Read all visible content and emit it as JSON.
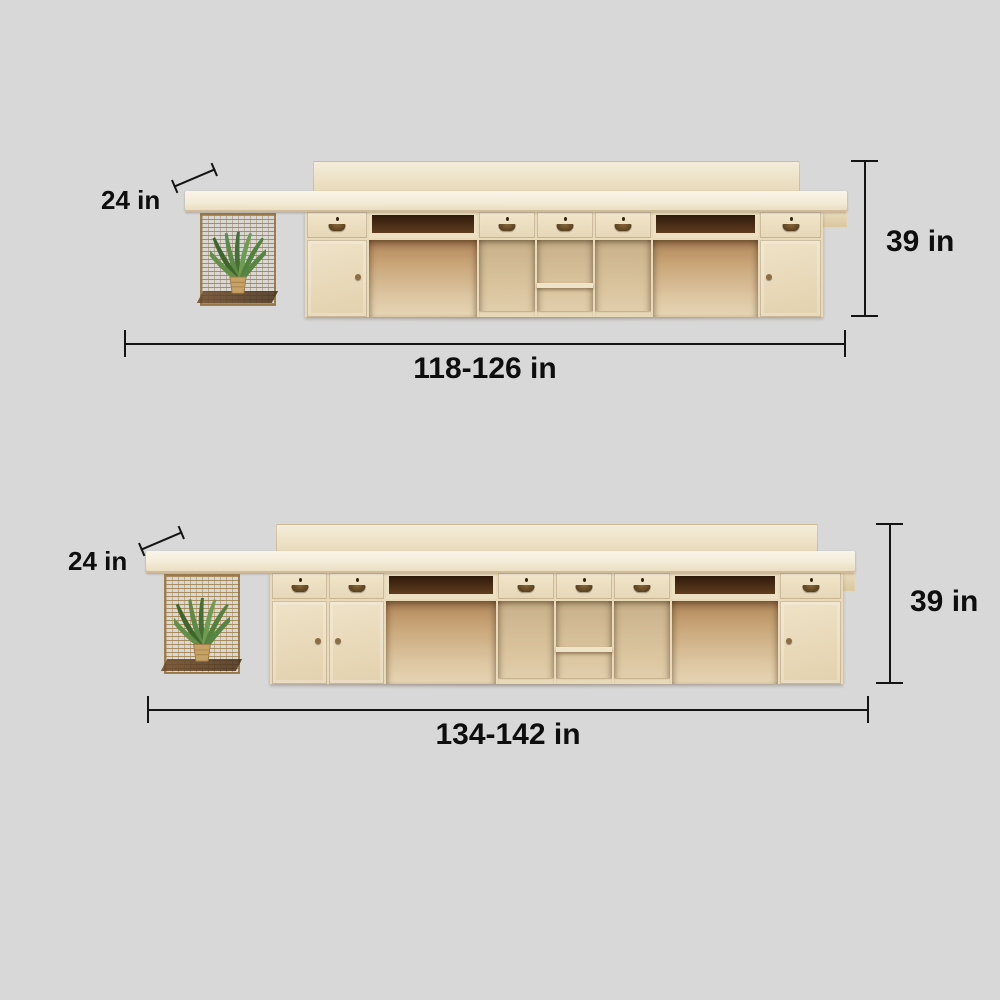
{
  "diagram": {
    "background_color": "#d8d8d8",
    "annotation_color": "#141414",
    "wood_colors": {
      "countertop": "#f7f0df",
      "front_panels": "#ecdfc2",
      "open_interior": "#d7c29d",
      "dark_niche": "#4a2b14",
      "wire_basket": "#a9804a",
      "plant_leaf": "#4e7b39"
    },
    "figures": [
      {
        "name": "desk-size-small",
        "labels": {
          "depth": "24 in",
          "height": "39 in",
          "width": "118-126 in"
        }
      },
      {
        "name": "desk-size-large",
        "labels": {
          "depth": "24 in",
          "height": "39 in",
          "width": "134-142 in"
        }
      }
    ]
  }
}
